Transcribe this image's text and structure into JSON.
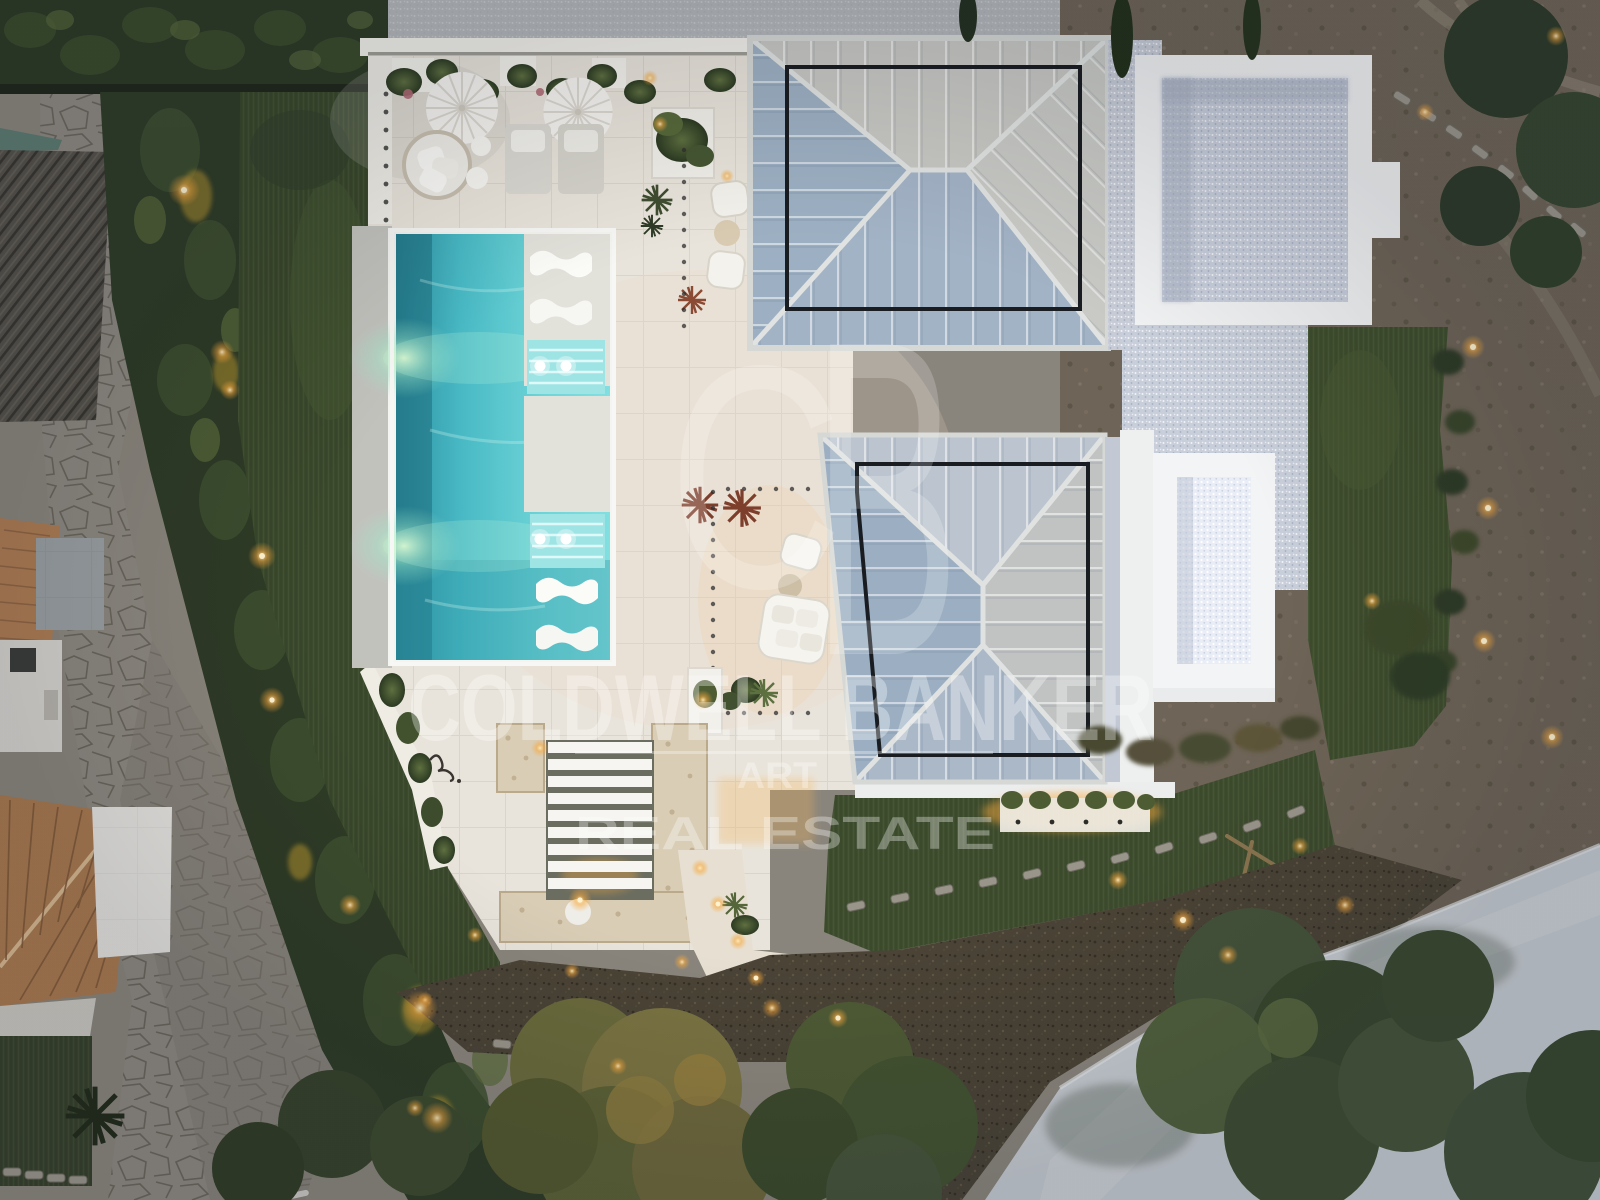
{
  "image": {
    "description": "Aerial dusk drone photograph of a modern luxury villa: turquoise pool with white loungers, travertine terraces, two standing-seam metal hip roofs, white-gravel flat roofs, artificial lawns, clipped hedges, stone driveway, neighbouring terracotta-roof houses and garden lights",
    "kind": "real-estate listing photo"
  },
  "watermark": {
    "monogram_c": "C",
    "monogram_b": "B",
    "wordmark": "COLDWELL BANKER",
    "subtitle_line1": "ART",
    "subtitle_line2": "REAL ESTATE",
    "color": "#ffffff"
  },
  "palette": {
    "pool_water": "#55c8cf",
    "pool_light_glow": "#d9f7c7",
    "deck": "#e9e4db",
    "metal_roof_blue": "#9fb0c3",
    "metal_roof_light": "#c8c8c4",
    "gravel_roof": "#c9cfda",
    "gravel_bright": "#e9edf5",
    "lawn": "#3f4e2f",
    "hedge": "#2e3b26",
    "warm_light": "#f6a83d",
    "terracotta": "#ae7c52",
    "stone_paving": "#8d8880",
    "dirt": "#6e6457",
    "road": "#c6cbd1"
  }
}
